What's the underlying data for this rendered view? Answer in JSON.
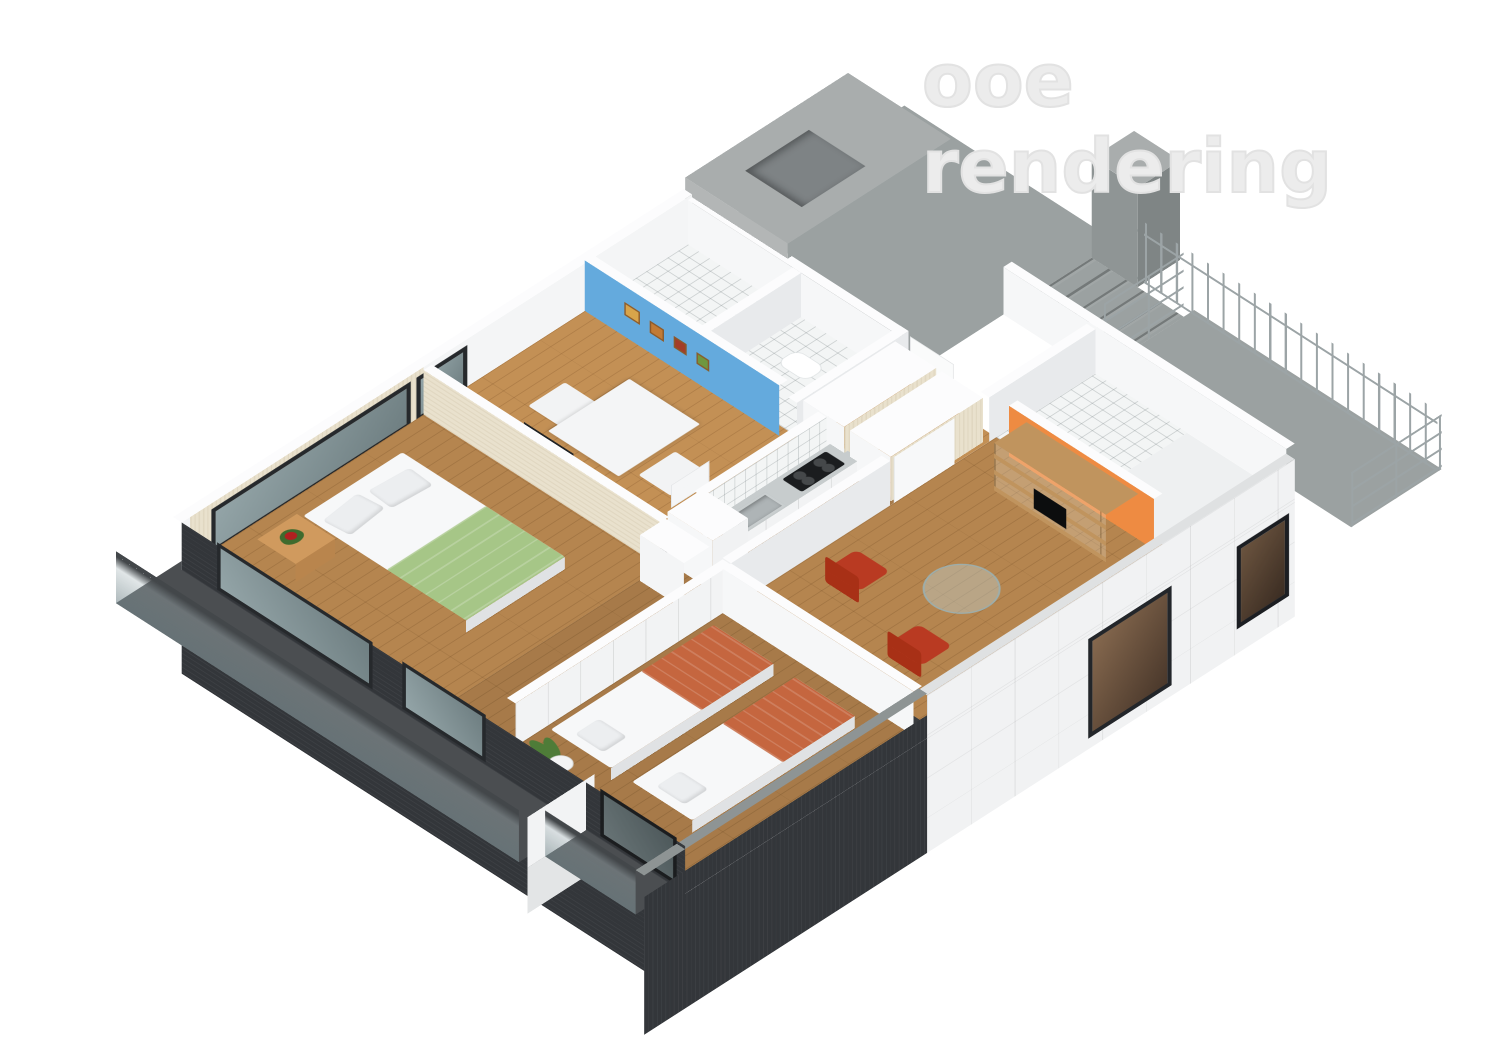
{
  "watermark": {
    "text": "ooe rendering"
  },
  "palette": {
    "background": "#ffffff",
    "watermark": "#ececec",
    "wood": "#b5854f",
    "wall_face": "#f6f7f8",
    "wall_shade": "#e8eaec",
    "wall_cap": "#fcfcfd",
    "beige_face": "#e9e1cd",
    "blue": "#64aadd",
    "orange": "#ee8b42",
    "green_bed": "#a6c687",
    "terracotta": "#c5663f",
    "red_chair": "#b93a22",
    "concrete": "#9ba1a1",
    "concrete_dark": "#7f8585",
    "concrete_roof": "#a9adad",
    "facade_dark": "#33363a",
    "steel": "#9ca4a6",
    "stainless": "#c7cccd",
    "pillow": "#eceef0",
    "sheet": "#f7f8f9",
    "shelf_wood": "#c0945e",
    "plant_green": "#4e7c38",
    "track": "#3a3c3f",
    "slab_dark": "#4b4e51"
  },
  "scene": {
    "kind": "isometric-3d-apartment-cutaway-rendering",
    "objects": [
      {
        "id": "bedroom-green",
        "items": [
          "double-bed-green-blanket",
          "nightstand-wood",
          "flower-red",
          "tv-flat-panel"
        ]
      },
      {
        "id": "dining-room",
        "items": [
          "blue-accent-wall",
          "picture-frames-x4",
          "white-dining-table",
          "white-chairs-x2"
        ]
      },
      {
        "id": "bathroom-tiled",
        "items": [
          "white-tile-floor",
          "toilet"
        ]
      },
      {
        "id": "kitchen",
        "items": [
          "stainless-counter",
          "sink",
          "black-cooktop",
          "tile-backsplash",
          "white-cabinets"
        ]
      },
      {
        "id": "living-room",
        "items": [
          "orange-accent-wall",
          "wood-shelf-unit-tv",
          "red-leather-chairs-x2",
          "round-glass-table"
        ]
      },
      {
        "id": "bedroom-twin",
        "items": [
          "single-bed-terracotta-x2",
          "potted-snake-plant",
          "sliding-closet-panels"
        ]
      },
      {
        "id": "shower-room",
        "items": [
          "white-tile-floor"
        ]
      },
      {
        "id": "common-area-concrete",
        "items": [
          "roof-slab-with-shaft",
          "concrete-chimney",
          "staircase",
          "external-walkway",
          "metal-railings"
        ]
      },
      {
        "id": "balconies-west",
        "items": [
          "dark-floor-slab",
          "glass-railing",
          "dark-window-facade"
        ]
      },
      {
        "id": "facade-south",
        "items": [
          "white-panel-cladding",
          "black-framed-windows",
          "dark-ribbed-cladding"
        ]
      }
    ]
  }
}
